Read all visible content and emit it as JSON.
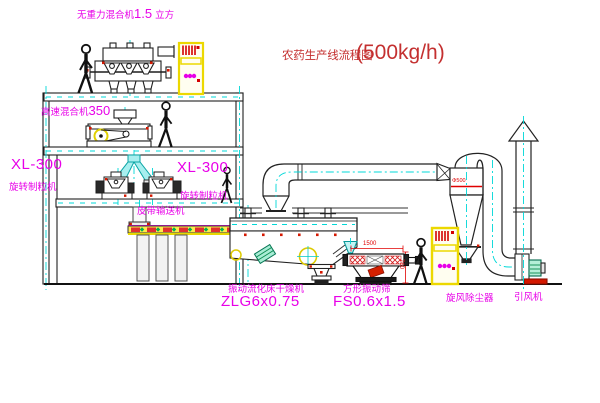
{
  "title": {
    "name": "农药生产线流程图",
    "capacity": "(500kg/h)"
  },
  "labels": {
    "gravity_free_mixer": {
      "name": "无重力混合机",
      "size_value": "1.5",
      "size_unit": "立方"
    },
    "high_speed_mixer": {
      "name": "高速混合机",
      "model": "350"
    },
    "granulator_left": {
      "model": "XL-300",
      "name": "旋转制粒机"
    },
    "granulator_right": {
      "model": "XL-300",
      "name": "旋转制粒机"
    },
    "belt_conveyor": "皮带输送机",
    "fluid_bed_dryer": {
      "name": "振动流化床干燥机",
      "model": "ZLG6x0.75"
    },
    "vibrating_sieve": {
      "name": "方形振动筛",
      "model": "FS0.6x1.5"
    },
    "cyclone": "旋风除尘器",
    "induced_draft_fan": "引风机"
  },
  "dimensions": {
    "sieve_length": "1500",
    "sieve_height": "760",
    "cyclone_note": "Φ500"
  },
  "colors": {
    "label_magenta": "#e800e8",
    "title_red": "#c43030",
    "dimension_red": "#e00000",
    "centerline_cyan": "#00d8d8",
    "cabinet_yellow": "#ecd800",
    "accent_red": "#d41800",
    "accent_green": "#0a8a50"
  }
}
